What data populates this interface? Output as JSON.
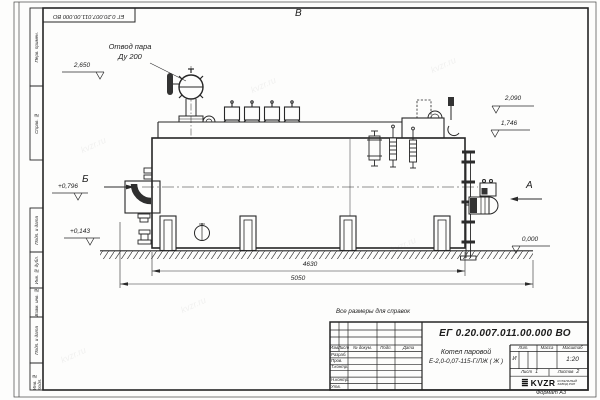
{
  "watermark": "kvzr.ru",
  "frame": {
    "stamp_top": "ЕГ 0.20.007.011.00.000  ВО",
    "format_label": "Формат А3",
    "margin_cells": [
      "Перв. примен.",
      "Справ. №",
      "Подп. и дата",
      "Инв. № дубл.",
      "Взам. инв. №",
      "Подп. и дата",
      "Инв. № подл."
    ]
  },
  "drawing": {
    "note": "Все размеры для справок",
    "labels": {
      "steam_outlet_1": "Отвод пара",
      "steam_outlet_2": "Ду 200"
    },
    "views": {
      "top": "В",
      "left": "Б",
      "right": "А"
    },
    "elevations": {
      "valve_top": "2,650",
      "right_upper": "2,090",
      "right_lower": "1,746",
      "left_mid": "+0,796",
      "left_low": "+0,143",
      "ground": "0,000"
    },
    "dimensions": {
      "shell_length": "4630",
      "overall_length": "5050"
    }
  },
  "title_block": {
    "doc_number": "ЕГ 0.20.007.011.00.000  ВО",
    "product_name_1": "Котел паровой",
    "product_name_2": "Е-2,0-0,07-115-Г/ЛЖ ( Ж )",
    "header_cols": [
      "Изм.",
      "Лист",
      "№ докум.",
      "Подп.",
      "Дата"
    ],
    "row_labels": [
      "Разраб.",
      "Пров.",
      "Т.контр.",
      "Н.контр.",
      "Утв."
    ],
    "lit_label": "Лит.",
    "lit_value": "И",
    "mass_label": "Масса",
    "scale_label": "Масштаб",
    "scale_value": "1:20",
    "sheet_label": "Лист",
    "sheet_number": "1",
    "sheets_label": "Листов",
    "sheets_total": "2",
    "company": {
      "logo": "KVZR",
      "tagline_1": "КОТЕЛЬНЫЙ",
      "tagline_2": "ЗАВОД РЭП"
    }
  }
}
